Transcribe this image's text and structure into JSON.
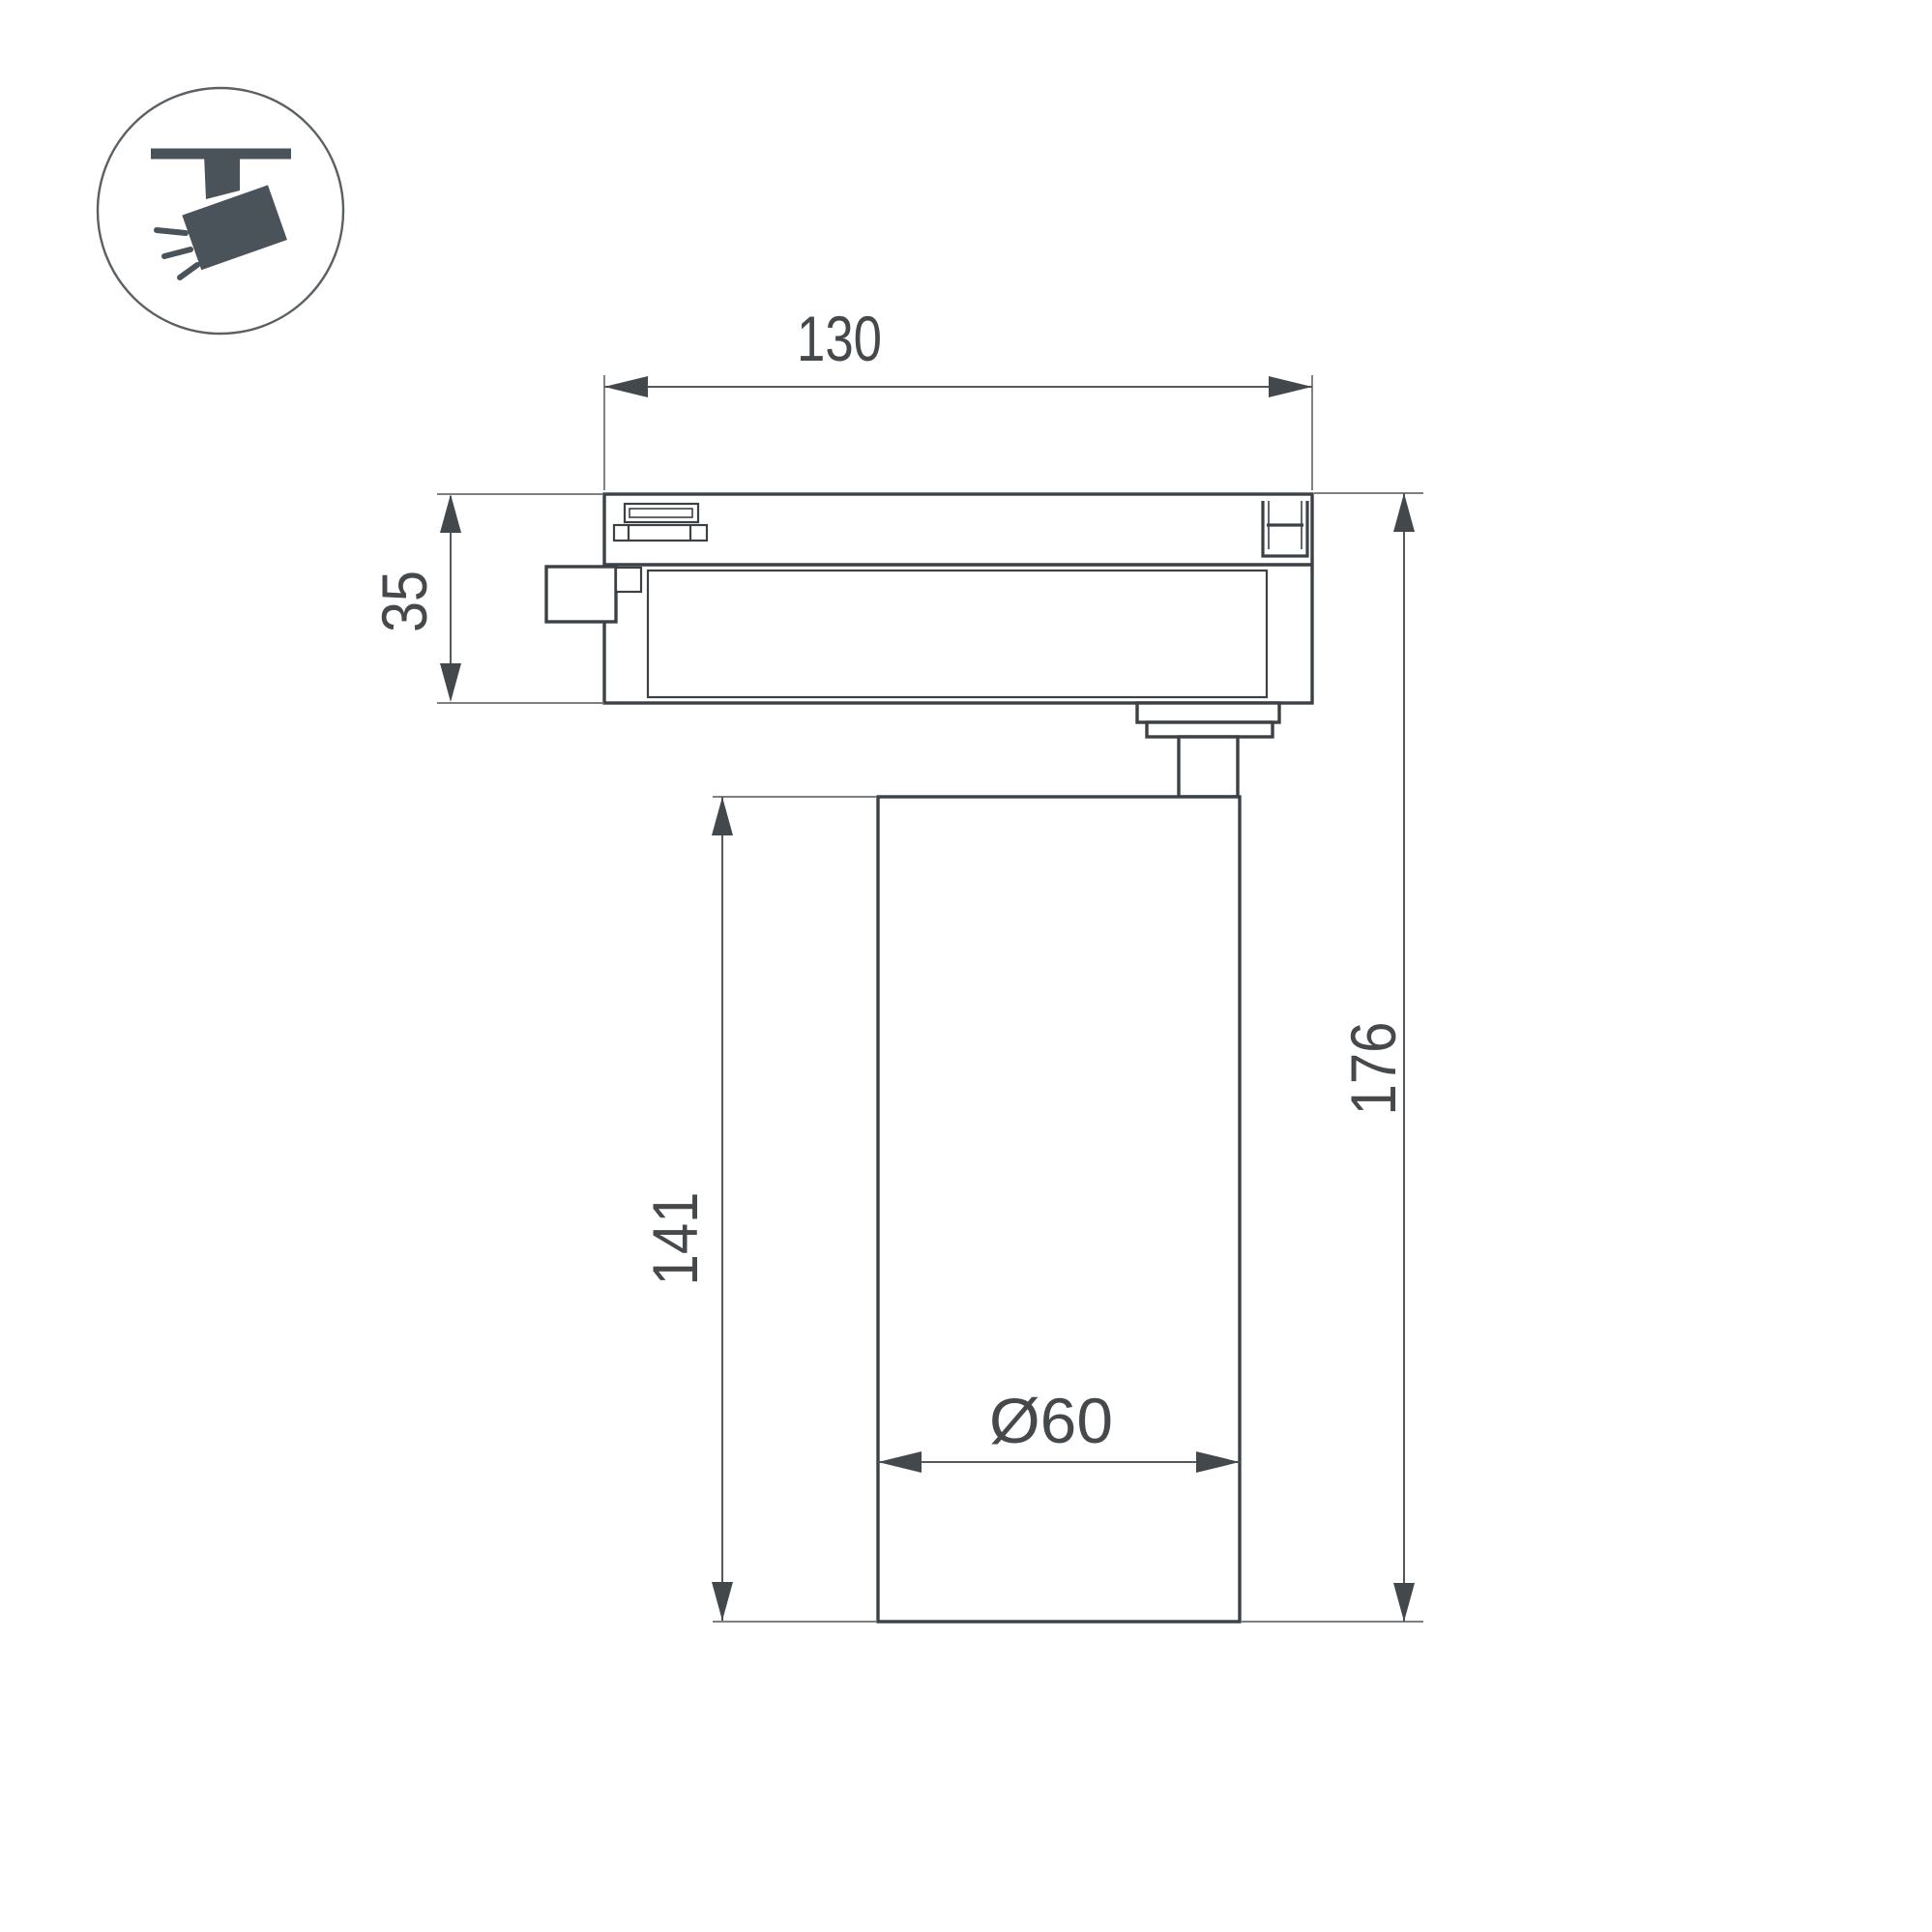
{
  "icon": {
    "name": "track-spotlight-icon"
  },
  "dimensions": {
    "width": "130",
    "adapter_height": "35",
    "body_height": "141",
    "overall_height": "176",
    "diameter": "Ø60"
  },
  "colors": {
    "line": "#3c4146",
    "dimension-line": "#55595d",
    "extension-line": "#6a6e71",
    "arrow": "#43484d",
    "text": "#46494c",
    "icon-fill": "#4a525a",
    "icon-stroke": "#5b6065",
    "background": "#ffffff"
  }
}
